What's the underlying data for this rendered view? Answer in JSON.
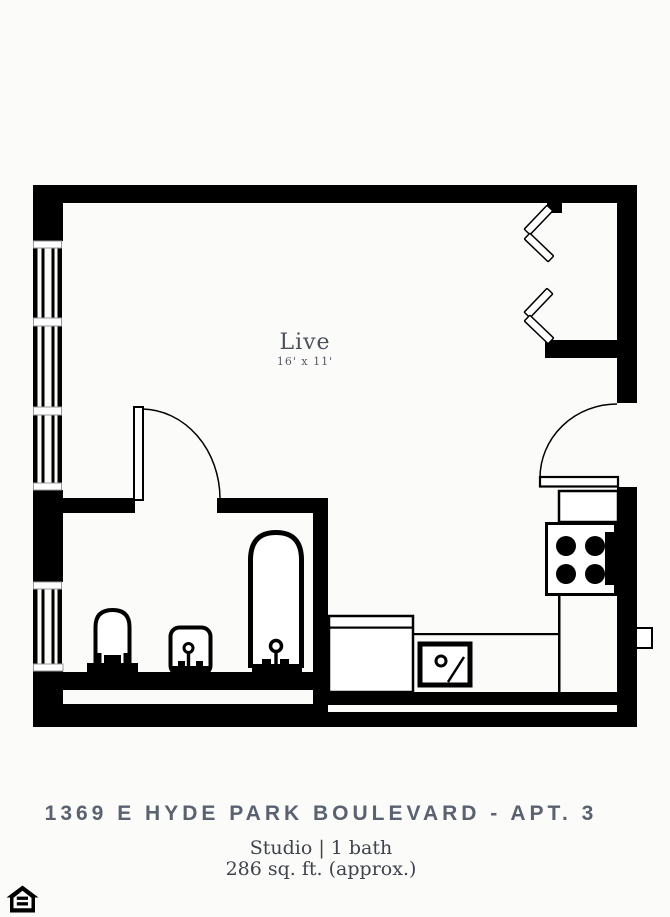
{
  "plan": {
    "room": {
      "name": "Live",
      "dimensions": "16' x 11'"
    },
    "fixtures": [
      "windows",
      "closet-bifold-doors",
      "entry-door",
      "bathroom-door",
      "toilet",
      "bathroom-sink",
      "bathtub",
      "refrigerator",
      "stove",
      "kitchen-counter",
      "kitchen-sink"
    ]
  },
  "footer": {
    "address": "1369 E HYDE PARK BOULEVARD - APT. 3",
    "unit": "Studio | 1 bath",
    "area": "286 sq. ft. (approx.)"
  },
  "colors": {
    "background": "#fbfbf9",
    "walls": "#000000",
    "room_label_text": "#4b505a",
    "address_text": "#5a6170",
    "details_text": "#3e434c",
    "window_frame_gray": "#999999"
  },
  "icons": {
    "bottom_left": "equal-housing-opportunity"
  }
}
